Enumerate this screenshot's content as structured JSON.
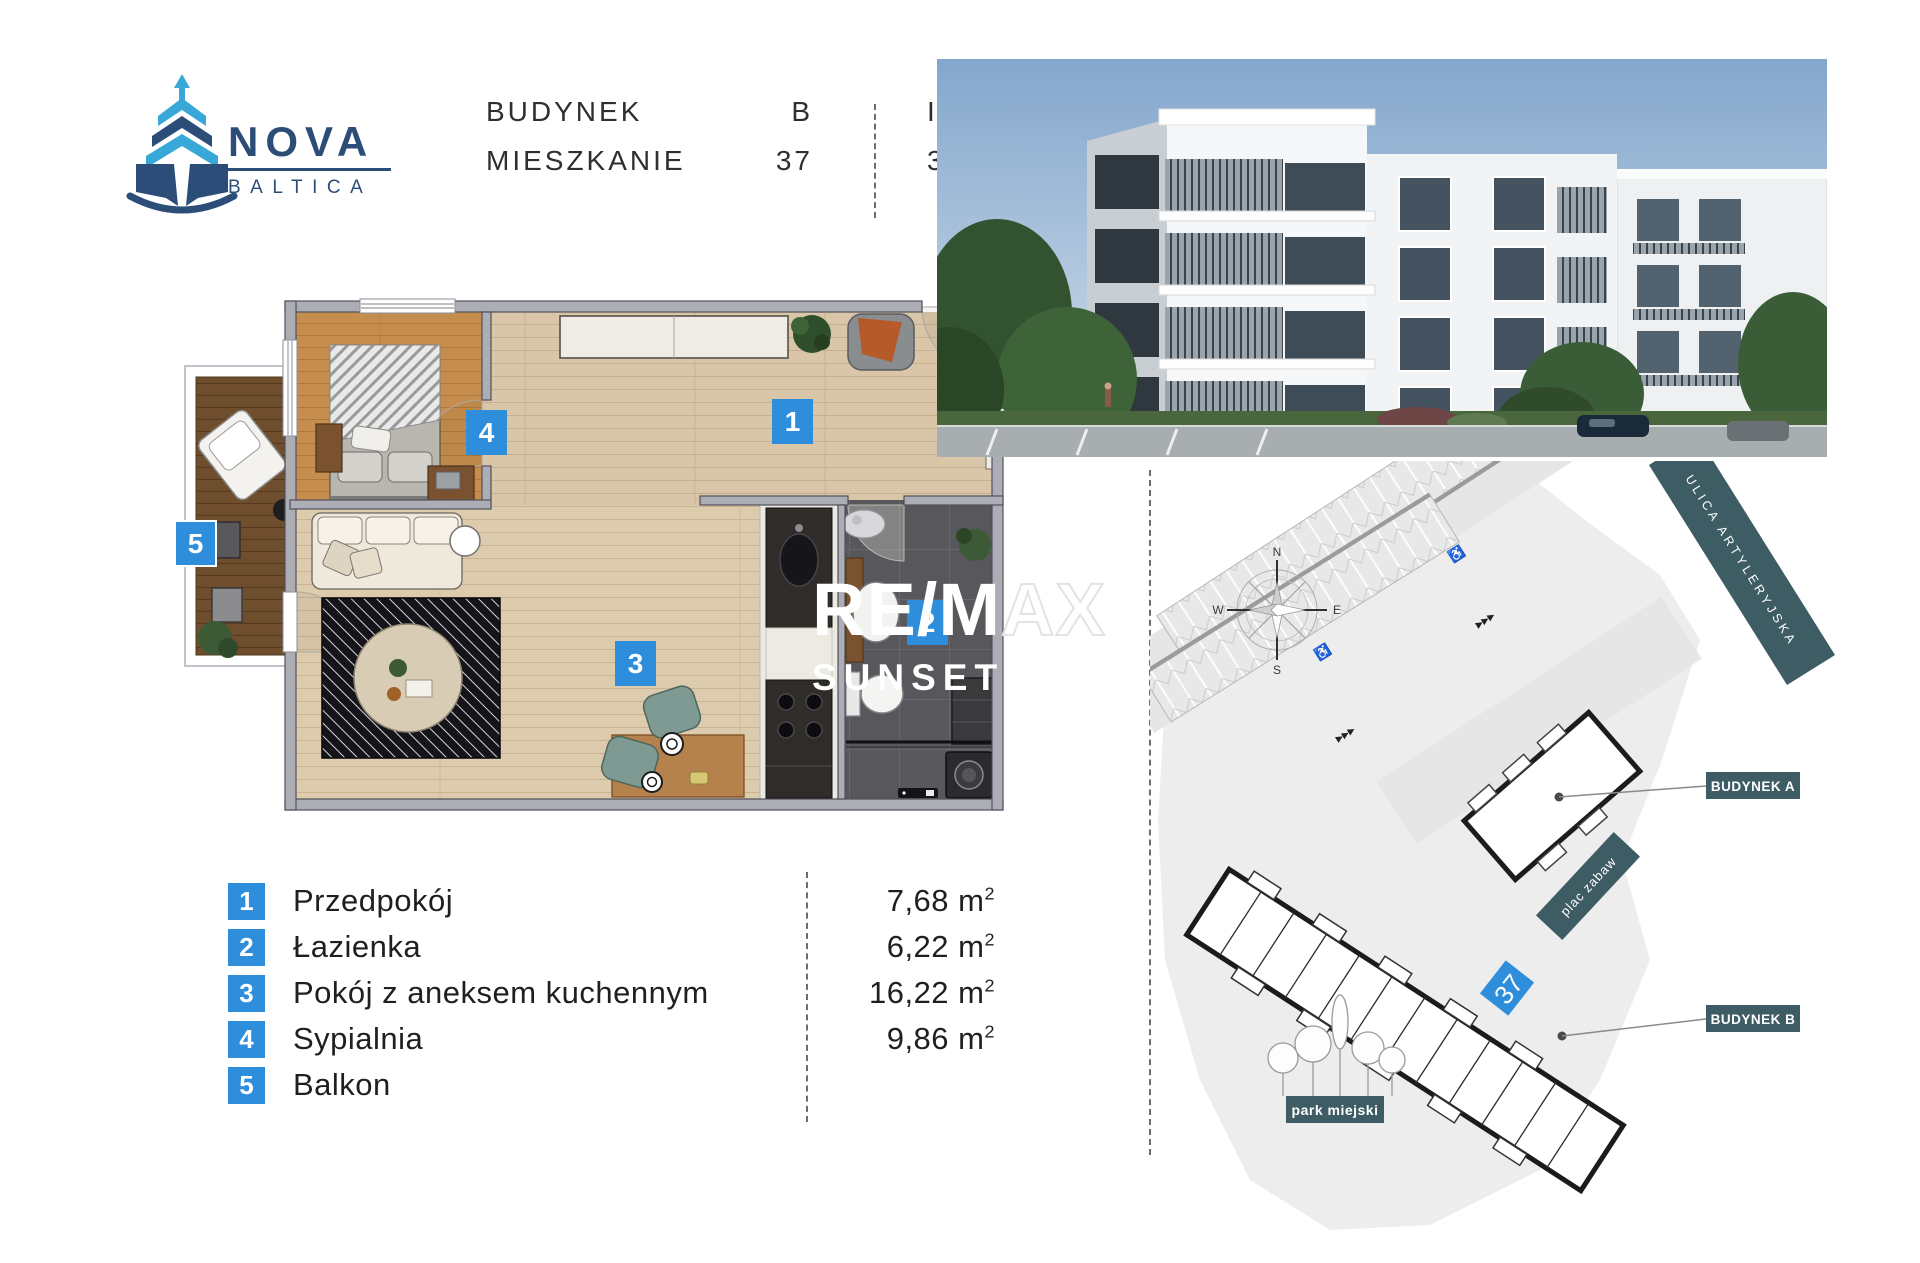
{
  "logo": {
    "line1": "NOVA",
    "line2": "BALTICA"
  },
  "header": {
    "building_label": "BUDYNEK",
    "building_value": "B",
    "apartment_label": "MIESZKANIE",
    "apartment_value": "37",
    "floor": "III PIĘTRO",
    "area_value": "39,98",
    "area_unit_base": "m",
    "area_unit_exp": "2"
  },
  "watermark": {
    "part_solid": "RE/M",
    "part_outline": "AX",
    "line2": "SUNSET"
  },
  "floorplan": {
    "badges": [
      "1",
      "2",
      "3",
      "4",
      "5"
    ]
  },
  "legend": {
    "rows": [
      {
        "num": "1",
        "label": "Przedpokój",
        "area": "7,68",
        "unit_base": "m",
        "unit_exp": "2"
      },
      {
        "num": "2",
        "label": "Łazienka",
        "area": "6,22",
        "unit_base": "m",
        "unit_exp": "2"
      },
      {
        "num": "3",
        "label": "Pokój z aneksem kuchennym",
        "area": "16,22",
        "unit_base": "m",
        "unit_exp": "2"
      },
      {
        "num": "4",
        "label": "Sypialnia",
        "area": "9,86",
        "unit_base": "m",
        "unit_exp": "2"
      },
      {
        "num": "5",
        "label": "Balkon",
        "area": "",
        "unit_base": "",
        "unit_exp": ""
      }
    ]
  },
  "siteplan": {
    "compass": {
      "n": "N",
      "e": "E",
      "s": "S",
      "w": "W"
    },
    "street": "ULICA ARTYLERYJSKA",
    "building_a": "BUDYNEK A",
    "building_b": "BUDYNEK B",
    "playground": "plac zabaw",
    "park": "park miejski",
    "unit_marker": "37"
  },
  "colors": {
    "accent_blue": "#2e8edb",
    "brand_navy": "#2d4d79",
    "brand_lightblue": "#38a8d8",
    "label_teal": "#3d5c63"
  }
}
